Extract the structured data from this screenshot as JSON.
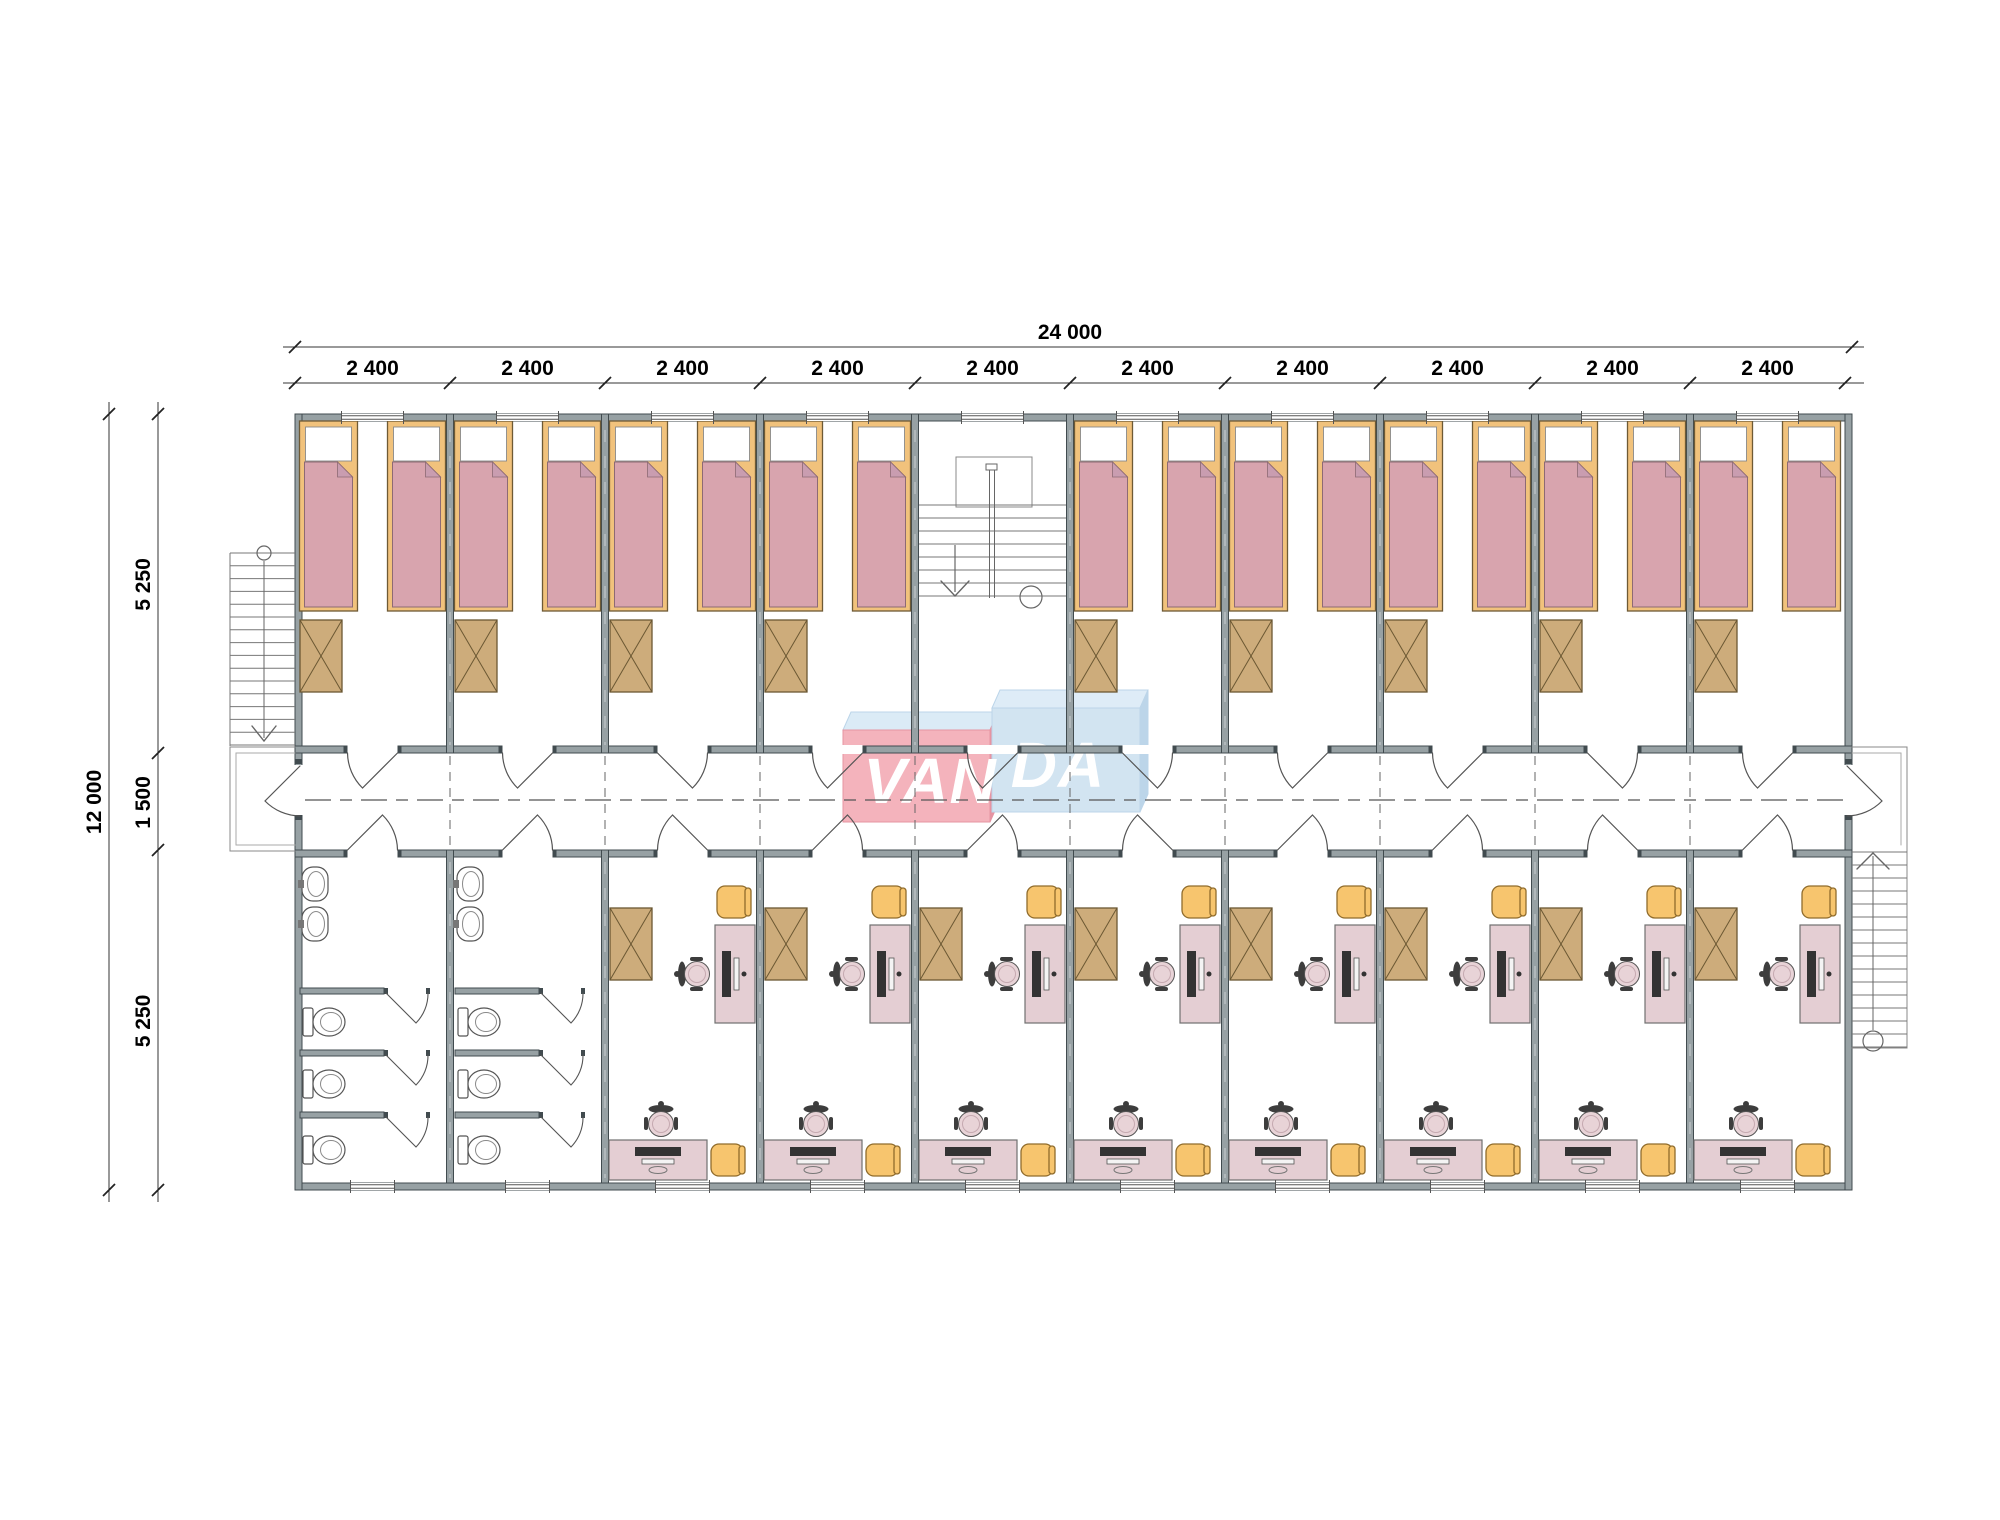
{
  "logo": {
    "text_left": "VAN",
    "text_right": "DA"
  },
  "dimensions": {
    "top_total": "24 000",
    "top_segments": [
      "2 400",
      "2 400",
      "2 400",
      "2 400",
      "2 400",
      "2 400",
      "2 400",
      "2 400",
      "2 400",
      "2 400"
    ],
    "left_total": "12 000",
    "left_segments": [
      "5 250",
      "1 500",
      "5 250"
    ]
  },
  "plan": {
    "top_row": [
      "bedroom",
      "bedroom",
      "bedroom",
      "bedroom",
      "stairwell",
      "bedroom",
      "bedroom",
      "bedroom",
      "bedroom",
      "bedroom"
    ],
    "bottom_row": [
      "bathroom",
      "bathroom",
      "study",
      "study",
      "study",
      "study",
      "study",
      "study",
      "study",
      "study"
    ],
    "bedroom": {
      "beds": 2,
      "wardrobes": 1,
      "windows": 1,
      "doors": 1
    },
    "bathroom": {
      "sinks": 2,
      "toilets": 3,
      "stalls": 3,
      "windows": 1,
      "doors": 1
    },
    "study": {
      "wardrobes": 1,
      "desks": 2,
      "task_chairs": 2,
      "side_chairs": 2,
      "windows": 1,
      "doors": 1
    },
    "stairs": [
      "exterior-left",
      "central-stairwell",
      "exterior-right"
    ]
  },
  "colors": {
    "wall": "#97a1a4",
    "wall_stroke": "#414b4f",
    "bed_frame": "#f1c27c",
    "bed_frame_stroke": "#6e5a35",
    "mattress": "#d8a4ae",
    "mattress_stroke": "#8d6a74",
    "mattress_fold": "#c99db0",
    "wardrobe": "#cdac7b",
    "wardrobe_stroke": "#6b5833",
    "desk": "#e4ced3",
    "desk_stroke": "#707070",
    "side_chair": "#f7c56e",
    "side_chair_stroke": "#906c2c",
    "task_chair_seat": "#e8d3d7",
    "task_chair_dark": "#3d3d3d",
    "fixture_stroke": "#555555",
    "stair_line": "#777777",
    "line": "#555555",
    "dim": "#000000",
    "logo_red_front": "#f4aeb8",
    "logo_red_side": "#e58c9b",
    "logo_blue_front": "#cfe2f1",
    "logo_blue_top": "#dcebf7",
    "logo_blue_side": "#b7d2e8",
    "logo_top_light": "#d9eaf6"
  }
}
